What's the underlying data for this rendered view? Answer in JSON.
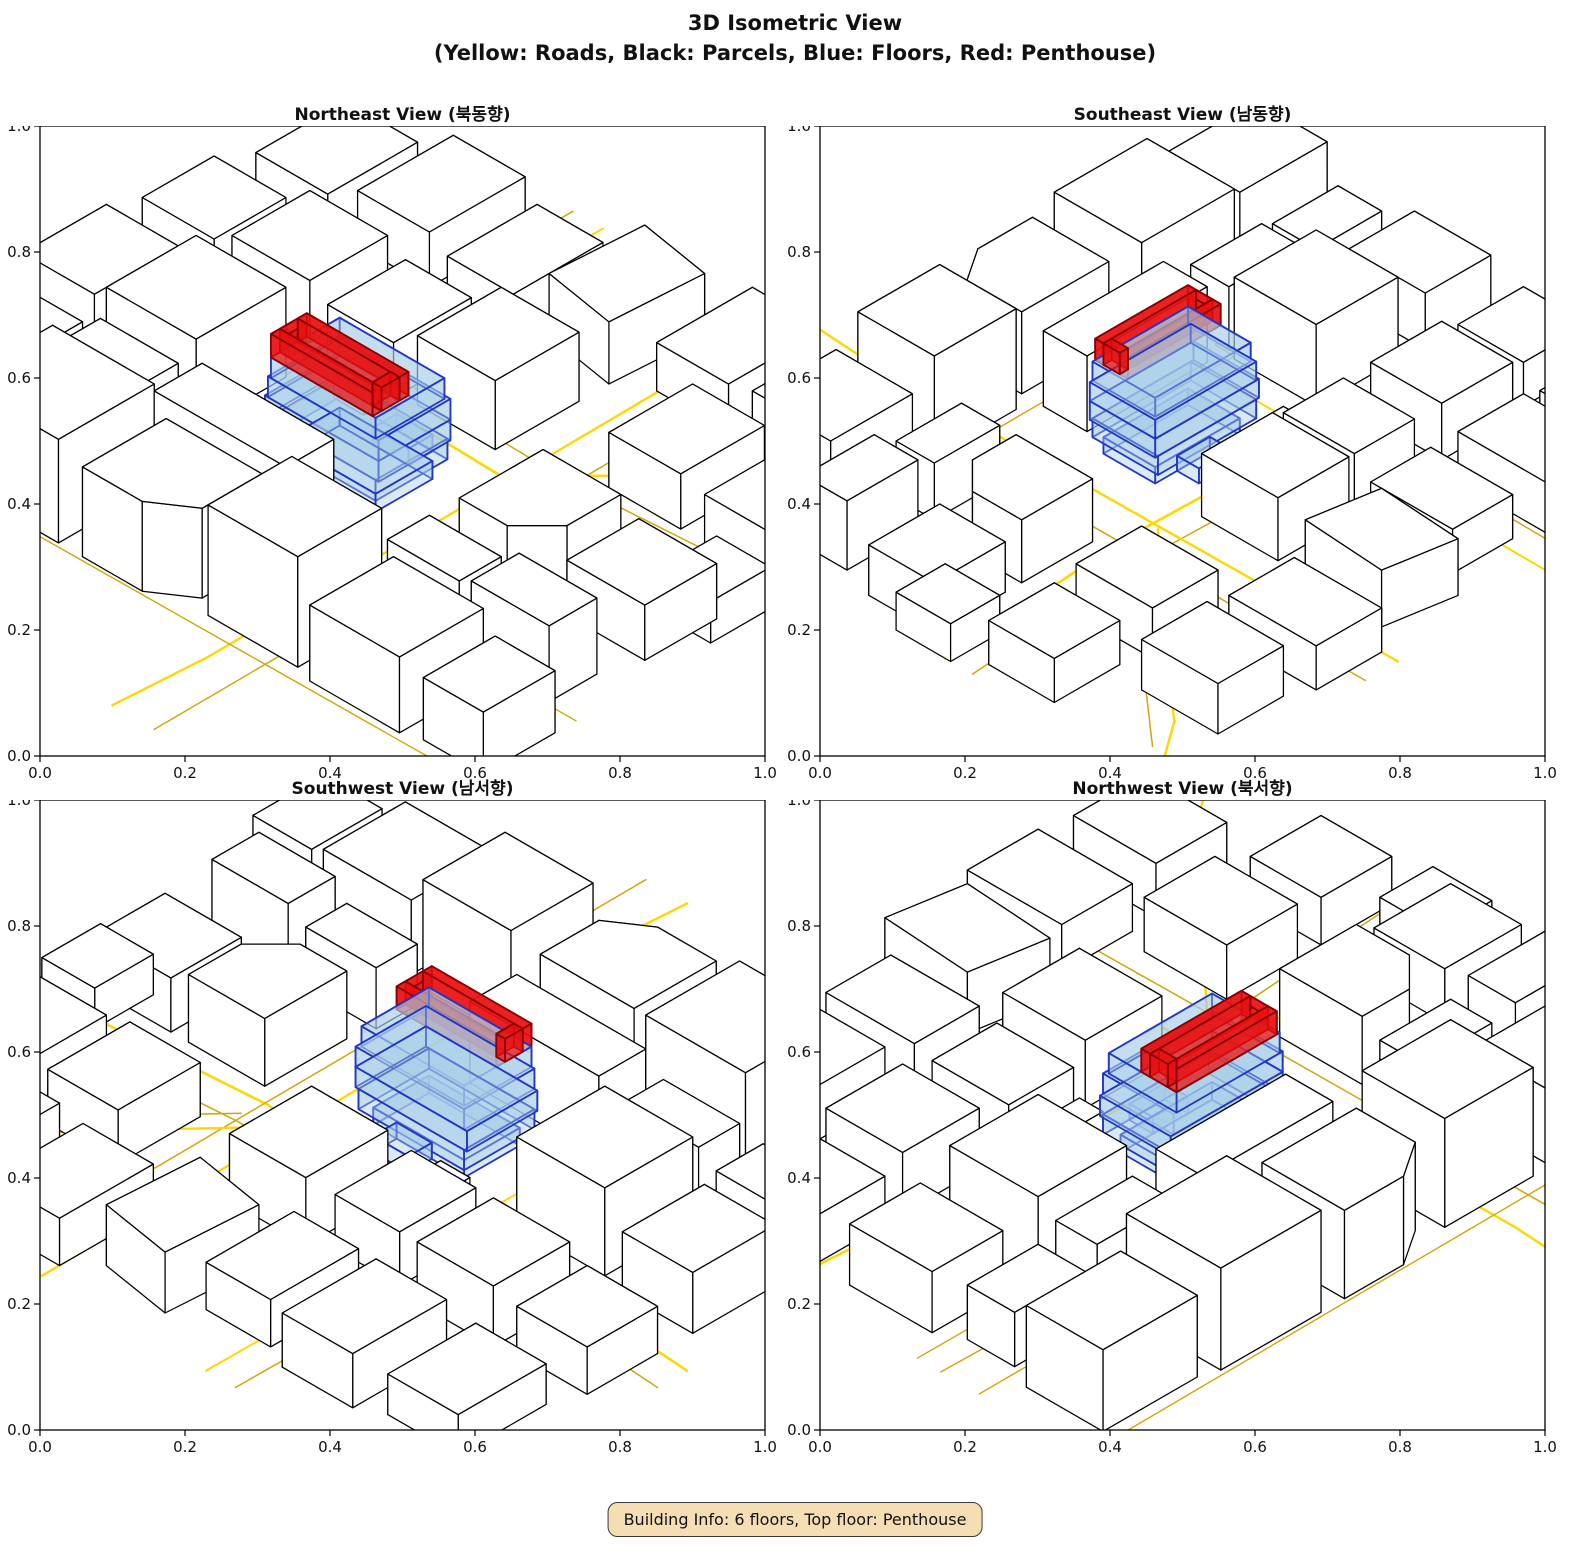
{
  "figure": {
    "title_line1": "3D Isometric View",
    "title_line2": "(Yellow: Roads, Black: Parcels, Blue: Floors, Red: Penthouse)"
  },
  "info_box": {
    "text": "Building Info: 6 floors, Top floor: Penthouse",
    "bg": "#F5DEB3"
  },
  "axis": {
    "ticks": [
      "0.0",
      "0.2",
      "0.4",
      "0.6",
      "0.8",
      "1.0"
    ],
    "min": 0.0,
    "max": 1.0
  },
  "legend": {
    "roads_color_name": "Yellow",
    "parcels_color_name": "Black",
    "floors_color_name": "Blue",
    "penthouse_color_name": "Red"
  },
  "colors": {
    "road": "#FFD700",
    "road_dim": "#CFA60A",
    "parcel_fill": "#FFFFFF",
    "parcel_edge": "#000000",
    "floor_fill": "#A8CCE8",
    "floor_edge": "#2237C4",
    "floor_opacity": 0.42,
    "penthouse_fill": "#EA1010",
    "penthouse_edge": "#8B0000",
    "penthouse_opacity": 0.74
  },
  "views": [
    {
      "name": "northeast",
      "title": "Northeast View (북동향)",
      "rotation_deg": 0
    },
    {
      "name": "southeast",
      "title": "Southeast View (남동향)",
      "rotation_deg": 270
    },
    {
      "name": "southwest",
      "title": "Southwest View (남서향)",
      "rotation_deg": 180
    },
    {
      "name": "northwest",
      "title": "Northwest View (북서향)",
      "rotation_deg": 90
    }
  ],
  "scene": {
    "roads": [
      {
        "pts": [
          [
            -55,
            -14
          ],
          [
            -20,
            -11.5
          ],
          [
            20,
            -10.5
          ],
          [
            55,
            -13
          ]
        ],
        "w": 2.6,
        "dim": false
      },
      {
        "pts": [
          [
            -55,
            -19
          ],
          [
            -20,
            -16.5
          ],
          [
            20,
            -15.5
          ],
          [
            55,
            -18
          ]
        ],
        "w": 1.5,
        "dim": true
      },
      {
        "pts": [
          [
            14,
            -55
          ],
          [
            14.5,
            -12
          ],
          [
            15,
            40
          ],
          [
            14,
            55
          ]
        ],
        "w": 2.4,
        "dim": false
      },
      {
        "pts": [
          [
            20,
            -55
          ],
          [
            20.5,
            -10
          ],
          [
            21,
            55
          ]
        ],
        "w": 1.5,
        "dim": true
      },
      {
        "pts": [
          [
            -14,
            -55
          ],
          [
            -14.5,
            12
          ]
        ],
        "w": 2.0,
        "dim": false
      },
      {
        "pts": [
          [
            -19,
            -55
          ],
          [
            -19.5,
            12
          ],
          [
            -30,
            13
          ],
          [
            -55,
            12.5
          ]
        ],
        "w": 1.5,
        "dim": true
      },
      {
        "pts": [
          [
            -55,
            8.5
          ],
          [
            -14,
            8.5
          ]
        ],
        "w": 1.4,
        "dim": true
      },
      {
        "pts": [
          [
            15,
            -12
          ],
          [
            30,
            -28
          ],
          [
            44,
            -44
          ],
          [
            55,
            -52
          ]
        ],
        "w": 2.4,
        "dim": false
      },
      {
        "pts": [
          [
            21,
            -14
          ],
          [
            36,
            -30
          ],
          [
            50,
            -46
          ]
        ],
        "w": 1.5,
        "dim": true
      },
      {
        "pts": [
          [
            -55,
            19
          ],
          [
            55,
            18.5
          ]
        ],
        "w": 1.4,
        "dim": true
      },
      {
        "pts": [
          [
            -55,
            37
          ],
          [
            55,
            36
          ]
        ],
        "w": 1.4,
        "dim": true
      }
    ],
    "parcels": [
      {
        "rect": [
          -50,
          22,
          -34,
          35
        ],
        "h": 12
      },
      {
        "rect": [
          -31,
          20,
          -14,
          36
        ],
        "h": 15
      },
      {
        "poly": [
          [
            -10,
            22
          ],
          [
            6,
            22
          ],
          [
            6,
            32
          ],
          [
            0,
            36
          ],
          [
            -10,
            36
          ]
        ],
        "h": 13
      },
      {
        "rect": [
          9,
          20,
          24,
          34
        ],
        "h": 16
      },
      {
        "rect": [
          27,
          21,
          42,
          35
        ],
        "h": 11
      },
      {
        "rect": [
          45,
          22,
          55,
          34
        ],
        "h": 9
      },
      {
        "rect": [
          -48,
          10,
          -36,
          18
        ],
        "h": 8
      },
      {
        "rect": [
          -33,
          10,
          -20,
          17
        ],
        "h": 10
      },
      {
        "rect": [
          -16,
          10,
          6,
          18
        ],
        "h": 12
      },
      {
        "rect": [
          22,
          10,
          34,
          17
        ],
        "h": 9
      },
      {
        "rect": [
          37,
          10,
          50,
          18
        ],
        "h": 11
      },
      {
        "rect": [
          -50,
          -8,
          -38,
          6
        ],
        "h": 9
      },
      {
        "rect": [
          -34,
          -7,
          -19,
          8
        ],
        "h": 13
      },
      {
        "poly": [
          [
            23,
            -8
          ],
          [
            36,
            -8
          ],
          [
            36,
            1
          ],
          [
            31,
            6
          ],
          [
            23,
            6
          ]
        ],
        "h": 10
      },
      {
        "rect": [
          39,
          -8,
          52,
          4
        ],
        "h": 8
      },
      {
        "rect": [
          -50,
          -26,
          -38,
          -14
        ],
        "h": 7
      },
      {
        "rect": [
          -35,
          -27,
          -22,
          -14
        ],
        "h": 9
      },
      {
        "rect": [
          -18,
          -26,
          -7,
          -13
        ],
        "h": 8
      },
      {
        "rect": [
          -4,
          -28,
          9,
          -14
        ],
        "h": 10
      },
      {
        "rect": [
          24,
          -32,
          36,
          -18
        ],
        "h": 8
      },
      {
        "rect": [
          40,
          -30,
          52,
          -18
        ],
        "h": 7
      },
      {
        "rect": [
          -48,
          -46,
          -36,
          -31
        ],
        "h": 6
      },
      {
        "rect": [
          -32,
          -48,
          -20,
          -32
        ],
        "h": 8
      },
      {
        "rect": [
          -16,
          -46,
          -5,
          -31
        ],
        "h": 7
      },
      {
        "poly": [
          [
            -2,
            -50
          ],
          [
            10,
            -48
          ],
          [
            9,
            -33
          ],
          [
            -3,
            -35
          ]
        ],
        "h": 9
      },
      {
        "rect": [
          14,
          -52,
          26,
          -36
        ],
        "h": 7
      },
      {
        "rect": [
          30,
          -50,
          42,
          -36
        ],
        "h": 8
      },
      {
        "rect": [
          -12,
          -12,
          -7,
          -8
        ],
        "h": 4
      },
      {
        "rect": [
          46,
          -14,
          55,
          -4
        ],
        "h": 6
      }
    ],
    "building": {
      "floors": [
        {
          "rect": [
            -7.5,
            -4.5,
            8,
            5
          ],
          "h": 2.6
        },
        {
          "rect": [
            -9,
            -6,
            9,
            6
          ],
          "h": 3.0
        },
        {
          "rect": [
            -9.5,
            -6,
            9.5,
            6
          ],
          "h": 3.0
        },
        {
          "rect": [
            -9,
            -6,
            9.5,
            6
          ],
          "h": 3.0
        },
        {
          "rect": [
            -8.5,
            -5.5,
            9,
            6
          ],
          "h": 3.0
        }
      ],
      "annex": {
        "rect": [
          -2,
          -8.5,
          4,
          -4.5
        ],
        "h": 2.4
      },
      "penthouse": {
        "outer": [
          -8.5,
          0,
          8.5,
          6
        ],
        "wall": 1.5,
        "h": 3.4
      }
    }
  }
}
